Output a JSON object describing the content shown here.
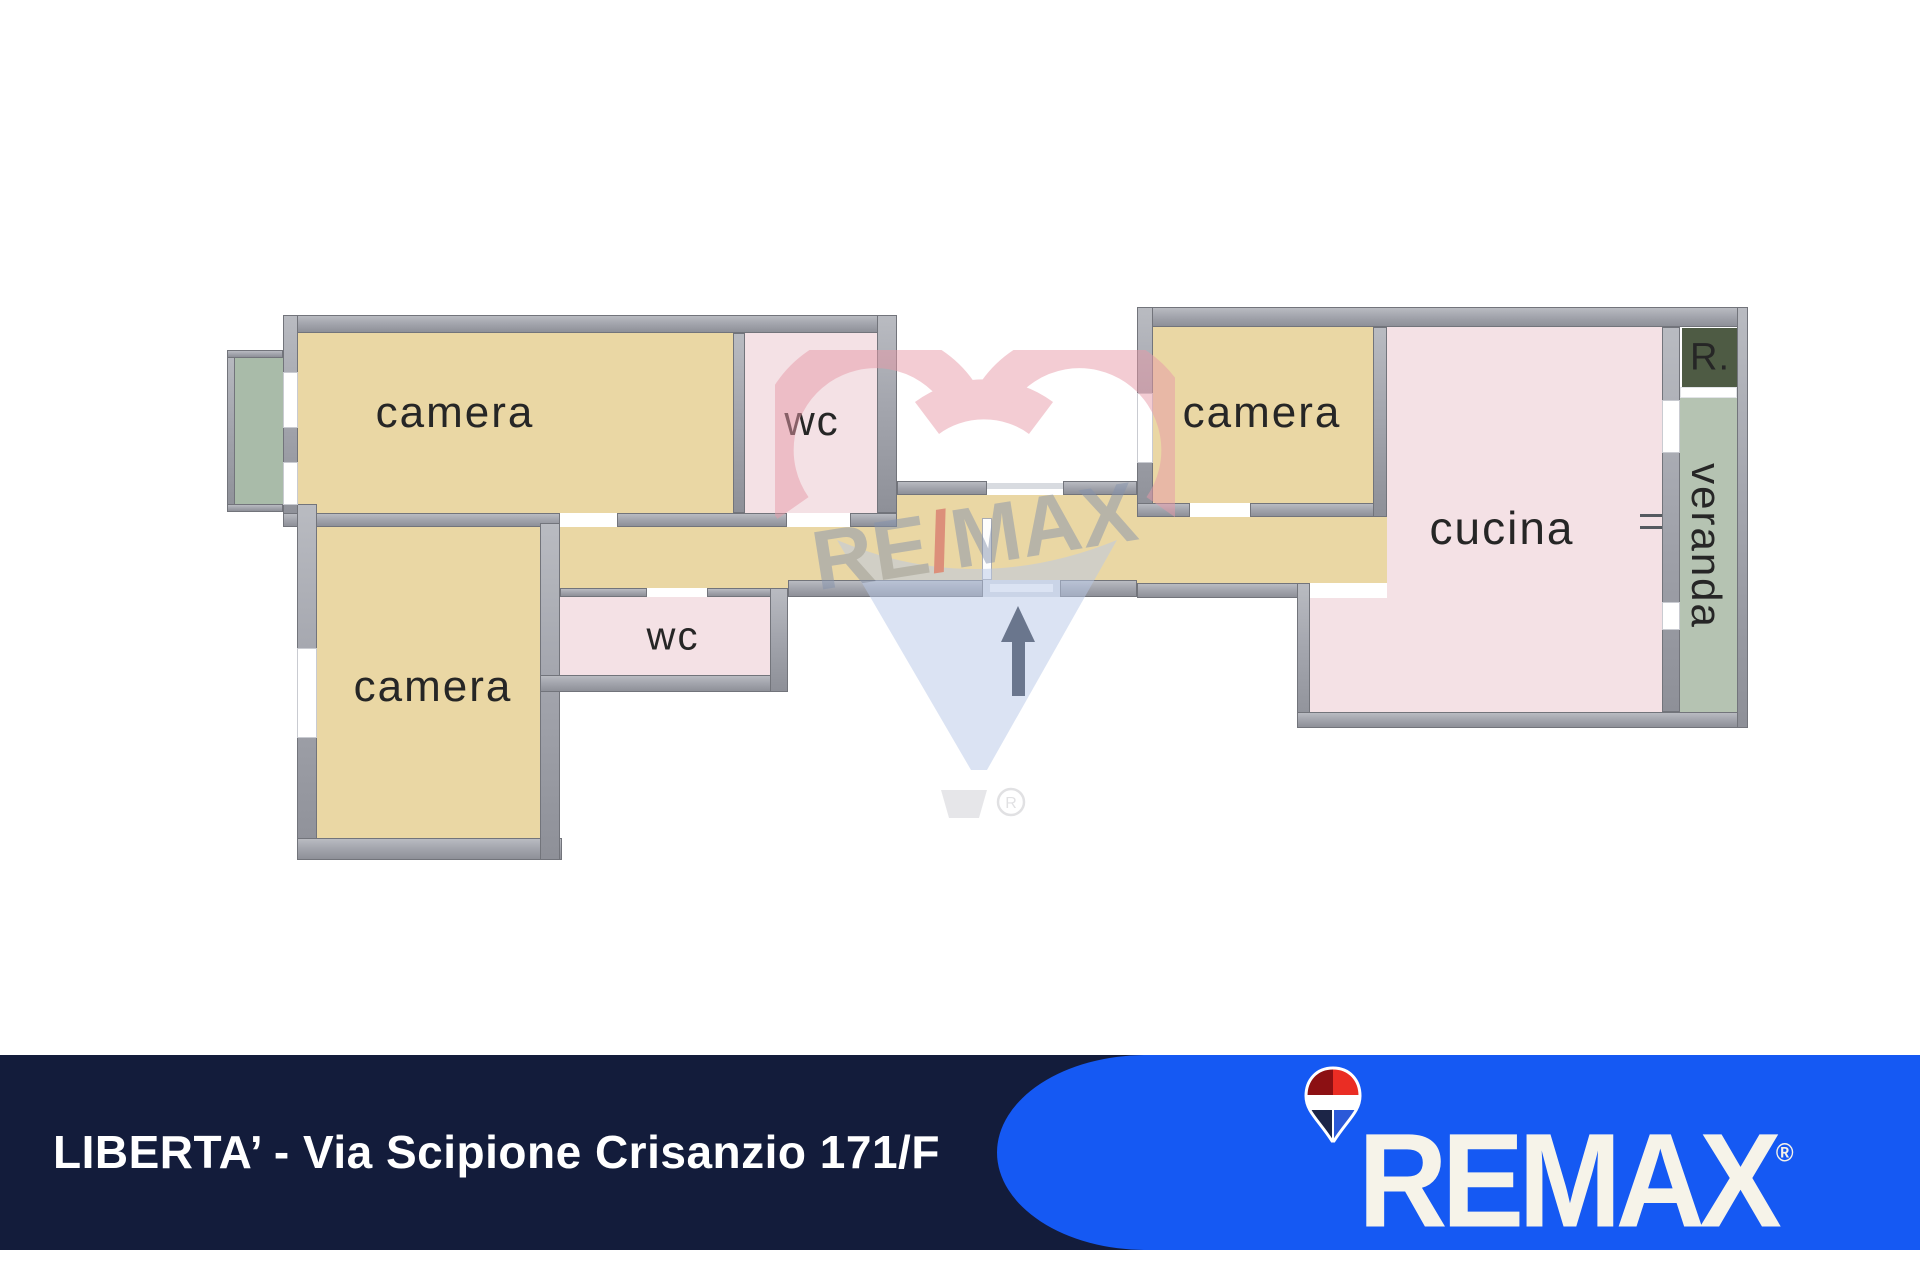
{
  "floor_plan": {
    "rooms": {
      "camera_top_left": {
        "label": "camera"
      },
      "wc_top": {
        "label": "wc"
      },
      "camera_bottom_left": {
        "label": "camera"
      },
      "wc_lower": {
        "label": "wc"
      },
      "camera_right": {
        "label": "camera"
      },
      "cucina": {
        "label": "cucina"
      },
      "veranda": {
        "label": "veranda"
      },
      "ripostiglio": {
        "label": "R."
      }
    },
    "watermark": {
      "re": "RE",
      "slash": "/",
      "max": "MAX",
      "registered": "R"
    }
  },
  "footer": {
    "address": "LIBERTA’ - Via Scipione Crisanzio 171/F",
    "brand_wordmark": "REMAX",
    "registered": "®"
  },
  "colors": {
    "wall": "#a4a6ae",
    "wall_dark": "#72747b",
    "room_tan": "#ead7a4",
    "room_pink": "#f4e1e5",
    "balcony_green": "#a9bba9",
    "veranda_green": "#b5c3b2",
    "ripostiglio_green": "#4e5b44",
    "arrow": "#1b2232",
    "bar_navy": "#131c3b",
    "brand_blue": "#1559f3",
    "logo_cream": "#f6f3e9",
    "logo_red": "#ea2d24",
    "logo_dark_red": "#8c1013",
    "logo_navy": "#1c2547",
    "logo_royal": "#2b59d8",
    "watermark_pink": "#e89aa8",
    "watermark_blue": "#b9c9e8",
    "watermark_gray": "#8593ad"
  }
}
